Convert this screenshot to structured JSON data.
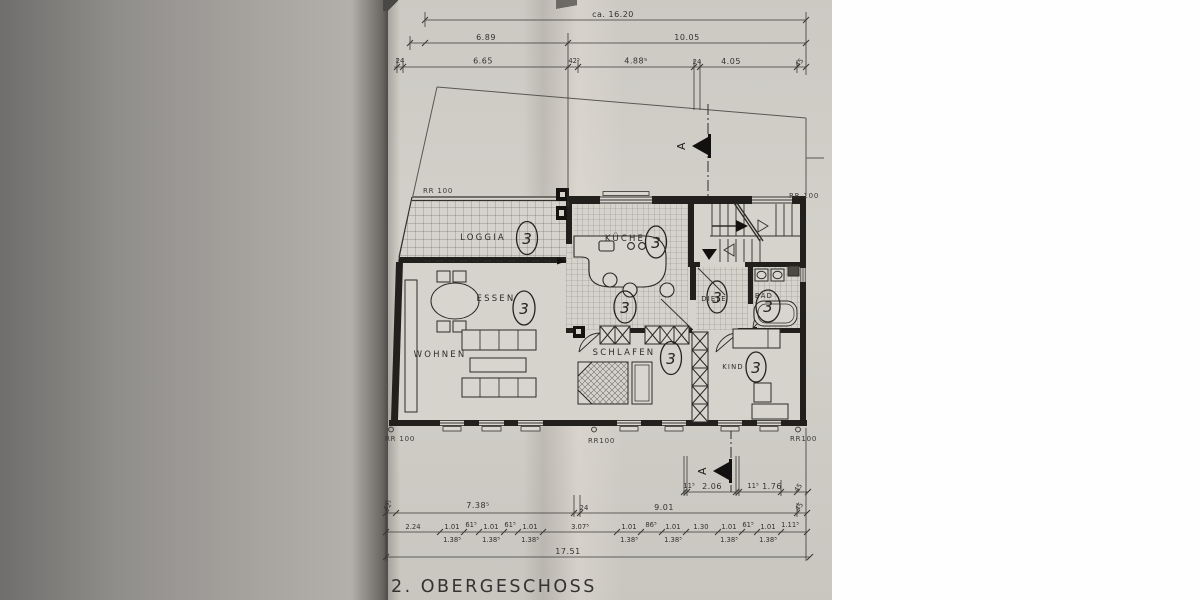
{
  "document": {
    "title": "2. OBERGESCHOSS"
  },
  "dims_top": {
    "overall": "ca. 16.20",
    "row2": [
      "6.89",
      "10.05"
    ],
    "row3": [
      "24",
      "6.65",
      "42⁵",
      "4.88⁵",
      "24",
      "4.05",
      "45"
    ]
  },
  "dims_bottom": {
    "section_row": [
      "11⁵",
      "2.06",
      "11⁵",
      "1.76",
      "45"
    ],
    "row1": [
      "42⁵",
      "7.38⁵",
      "24",
      "9.01",
      "45"
    ],
    "row2": [
      "2.24",
      "1.01",
      "61⁵",
      "1.01",
      "61⁵",
      "1.01",
      "3.07⁵",
      "1.01",
      "86⁵",
      "1.01",
      "1.30",
      "1.01",
      "61⁵",
      "1.01",
      "1.11⁵"
    ],
    "row2b": [
      "1.38⁵",
      "1.38⁵",
      "1.38⁵",
      "1.38⁵",
      "1.38⁵",
      "1.38⁵",
      "1.38⁵"
    ],
    "row3": "17.51"
  },
  "rooms": {
    "loggia": {
      "label": "LOGGIA",
      "number": "3"
    },
    "kueche": {
      "label": "KÜCHE",
      "number": "3"
    },
    "flur": {
      "label": "",
      "number": "3"
    },
    "essen": {
      "label": "ESSEN",
      "number": "3"
    },
    "wohnen": {
      "label": "WOHNEN",
      "number": ""
    },
    "diele": {
      "label": "DIELE",
      "number": "3"
    },
    "bad": {
      "label": "BAD",
      "number": "3"
    },
    "schlafen": {
      "label": "SCHLAFEN",
      "number": "3"
    },
    "kind": {
      "label": "KIND",
      "number": "3"
    }
  },
  "annotations": {
    "rr_top_left": "RR 100",
    "rr_top_right": "RR 100",
    "rr_bottom_left": "RR 100",
    "rr_bottom_mid": "RR100",
    "rr_bottom_right": "RR100",
    "section_letter": "A"
  }
}
